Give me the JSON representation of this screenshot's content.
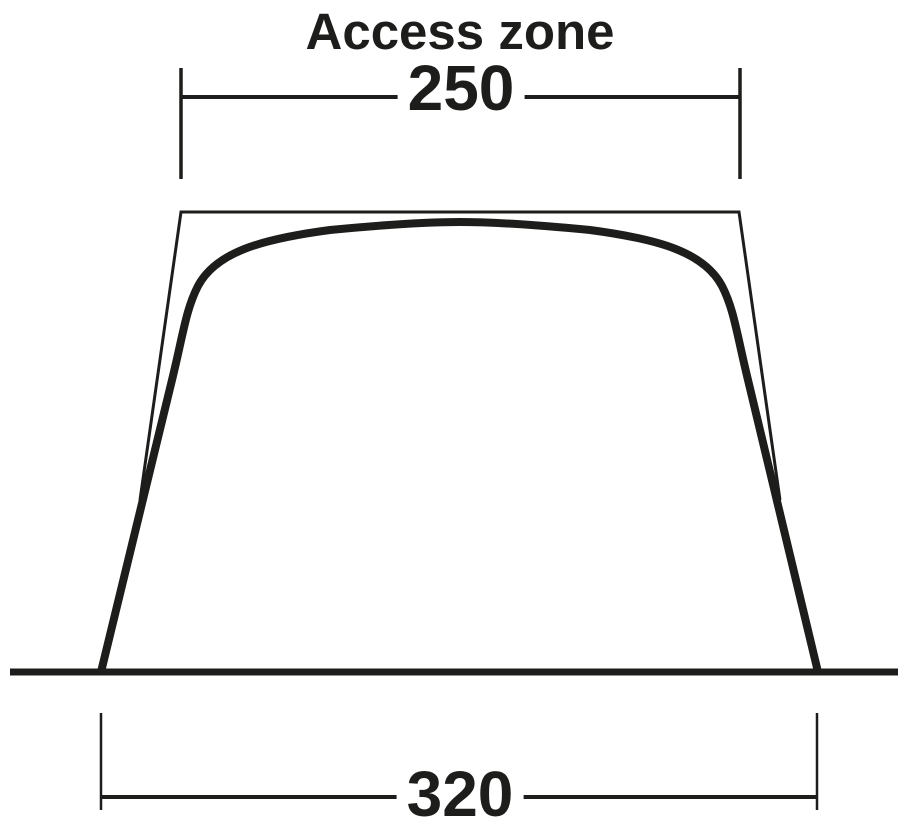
{
  "diagram": {
    "title": "Access zone",
    "dimensions": {
      "top": {
        "value": "250",
        "unit": ""
      },
      "bottom": {
        "value": "320",
        "unit": ""
      }
    },
    "shape": "tent-front-elevation",
    "colors": {
      "ink": "#1d1d1b",
      "background": "#ffffff"
    }
  }
}
